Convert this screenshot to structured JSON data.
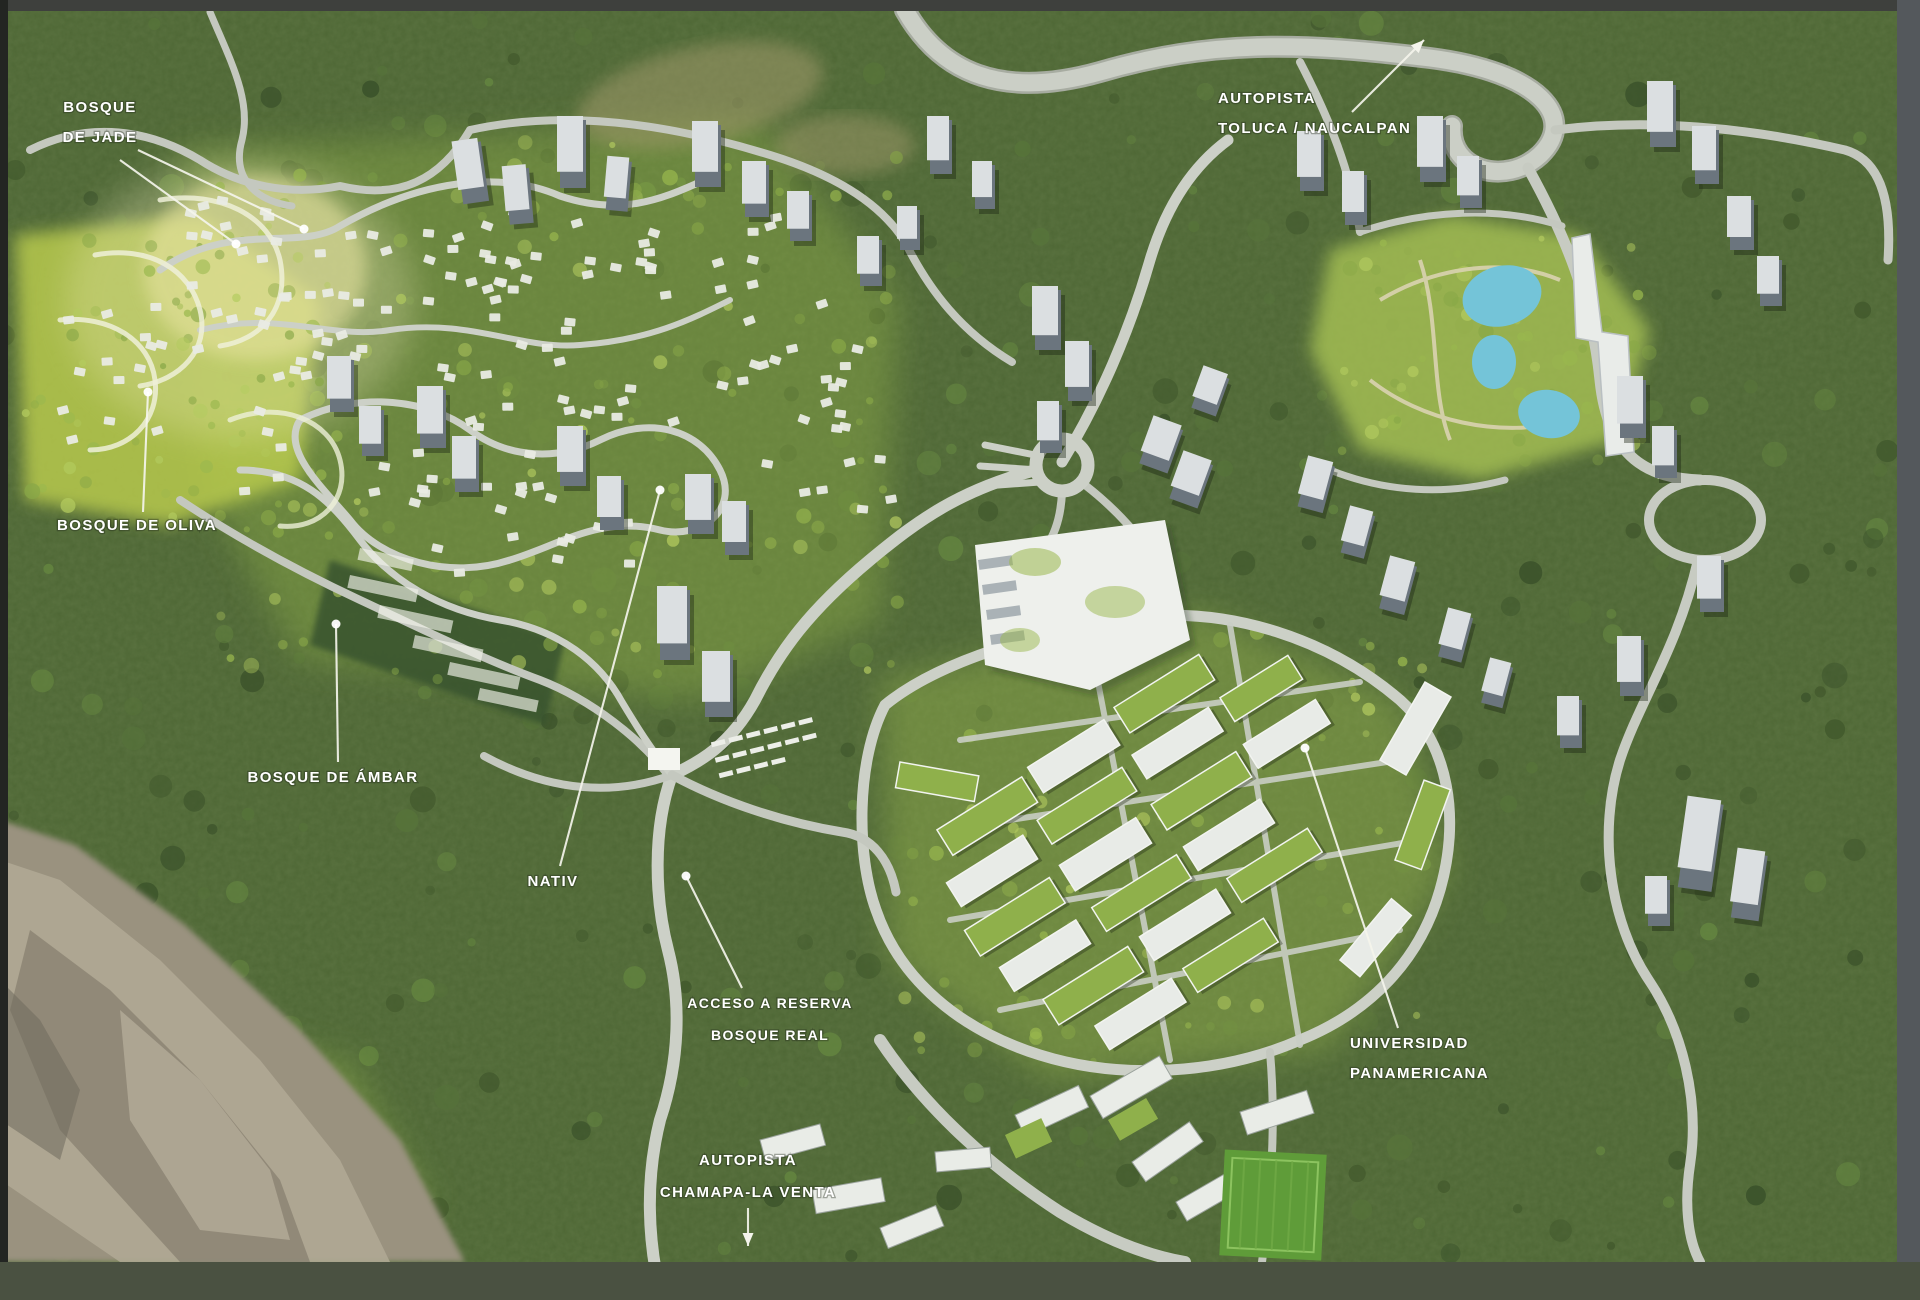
{
  "meta": {
    "alt": "Aerial masterplan render of a forested residential development with labeled districts, access roads and highways"
  },
  "palette": {
    "forest_green": "#4e6735",
    "development_green": "#a9c355",
    "road_grey": "#ccd0c7",
    "building_white": "#edefeb",
    "tower_grey": "#6b757e",
    "pond_blue": "#74c4d8",
    "rock_tan": "#a29a86",
    "label_text": "#ffffff",
    "frame_top": "#3e403d",
    "frame_bottom": "#4a5141",
    "frame_right": "#54585c",
    "frame_left": "#232522"
  },
  "labels": [
    {
      "id": "bosque-de-jade",
      "lines": [
        "BOSQUE",
        "DE JADE"
      ],
      "x": 100,
      "y": 112,
      "anchor": "middle",
      "font_size": 15,
      "line_height": 30,
      "leaders": [
        {
          "x1": 120,
          "y1": 160,
          "x2": 236,
          "y2": 244,
          "dot": true
        },
        {
          "x1": 138,
          "y1": 150,
          "x2": 304,
          "y2": 229,
          "dot": true
        }
      ]
    },
    {
      "id": "bosque-de-oliva",
      "lines": [
        "BOSQUE DE OLIVA"
      ],
      "x": 137,
      "y": 530,
      "anchor": "middle",
      "font_size": 15,
      "line_height": 30,
      "leaders": [
        {
          "x1": 143,
          "y1": 512,
          "x2": 148,
          "y2": 392,
          "dot": true
        }
      ]
    },
    {
      "id": "bosque-de-ambar",
      "lines": [
        "BOSQUE DE ÁMBAR"
      ],
      "x": 333,
      "y": 782,
      "anchor": "middle",
      "font_size": 15,
      "line_height": 30,
      "leaders": [
        {
          "x1": 338,
          "y1": 762,
          "x2": 336,
          "y2": 624,
          "dot": true
        }
      ]
    },
    {
      "id": "nativ",
      "lines": [
        "NATIV"
      ],
      "x": 553,
      "y": 886,
      "anchor": "middle",
      "font_size": 15,
      "line_height": 30,
      "leaders": [
        {
          "x1": 560,
          "y1": 866,
          "x2": 660,
          "y2": 490,
          "dot": true
        }
      ]
    },
    {
      "id": "acceso-a-reserva-bosque-real",
      "lines": [
        "ACCESO A RESERVA",
        "BOSQUE REAL"
      ],
      "x": 770,
      "y": 1008,
      "anchor": "middle",
      "font_size": 14,
      "line_height": 32,
      "leaders": [
        {
          "x1": 742,
          "y1": 988,
          "x2": 686,
          "y2": 876,
          "dot": true
        }
      ]
    },
    {
      "id": "autopista-toluca-naucalpan",
      "lines": [
        "AUTOPISTA",
        "TOLUCA / NAUCALPAN"
      ],
      "x": 1218,
      "y": 103,
      "anchor": "start",
      "font_size": 15,
      "line_height": 30,
      "leaders": [
        {
          "x1": 1352,
          "y1": 112,
          "x2": 1424,
          "y2": 40,
          "arrow": true
        }
      ]
    },
    {
      "id": "universidad-panamericana",
      "lines": [
        "UNIVERSIDAD",
        "PANAMERICANA"
      ],
      "x": 1350,
      "y": 1048,
      "anchor": "start",
      "font_size": 15,
      "line_height": 30,
      "leaders": [
        {
          "x1": 1398,
          "y1": 1028,
          "x2": 1305,
          "y2": 748,
          "dot": true
        }
      ]
    },
    {
      "id": "autopista-chamapa-la-venta",
      "lines": [
        "AUTOPISTA",
        "CHAMAPA-LA VENTA"
      ],
      "x": 748,
      "y": 1165,
      "anchor": "middle",
      "font_size": 15,
      "line_height": 32,
      "leaders": [
        {
          "x1": 748,
          "y1": 1208,
          "x2": 748,
          "y2": 1246,
          "arrow": true
        }
      ]
    }
  ]
}
